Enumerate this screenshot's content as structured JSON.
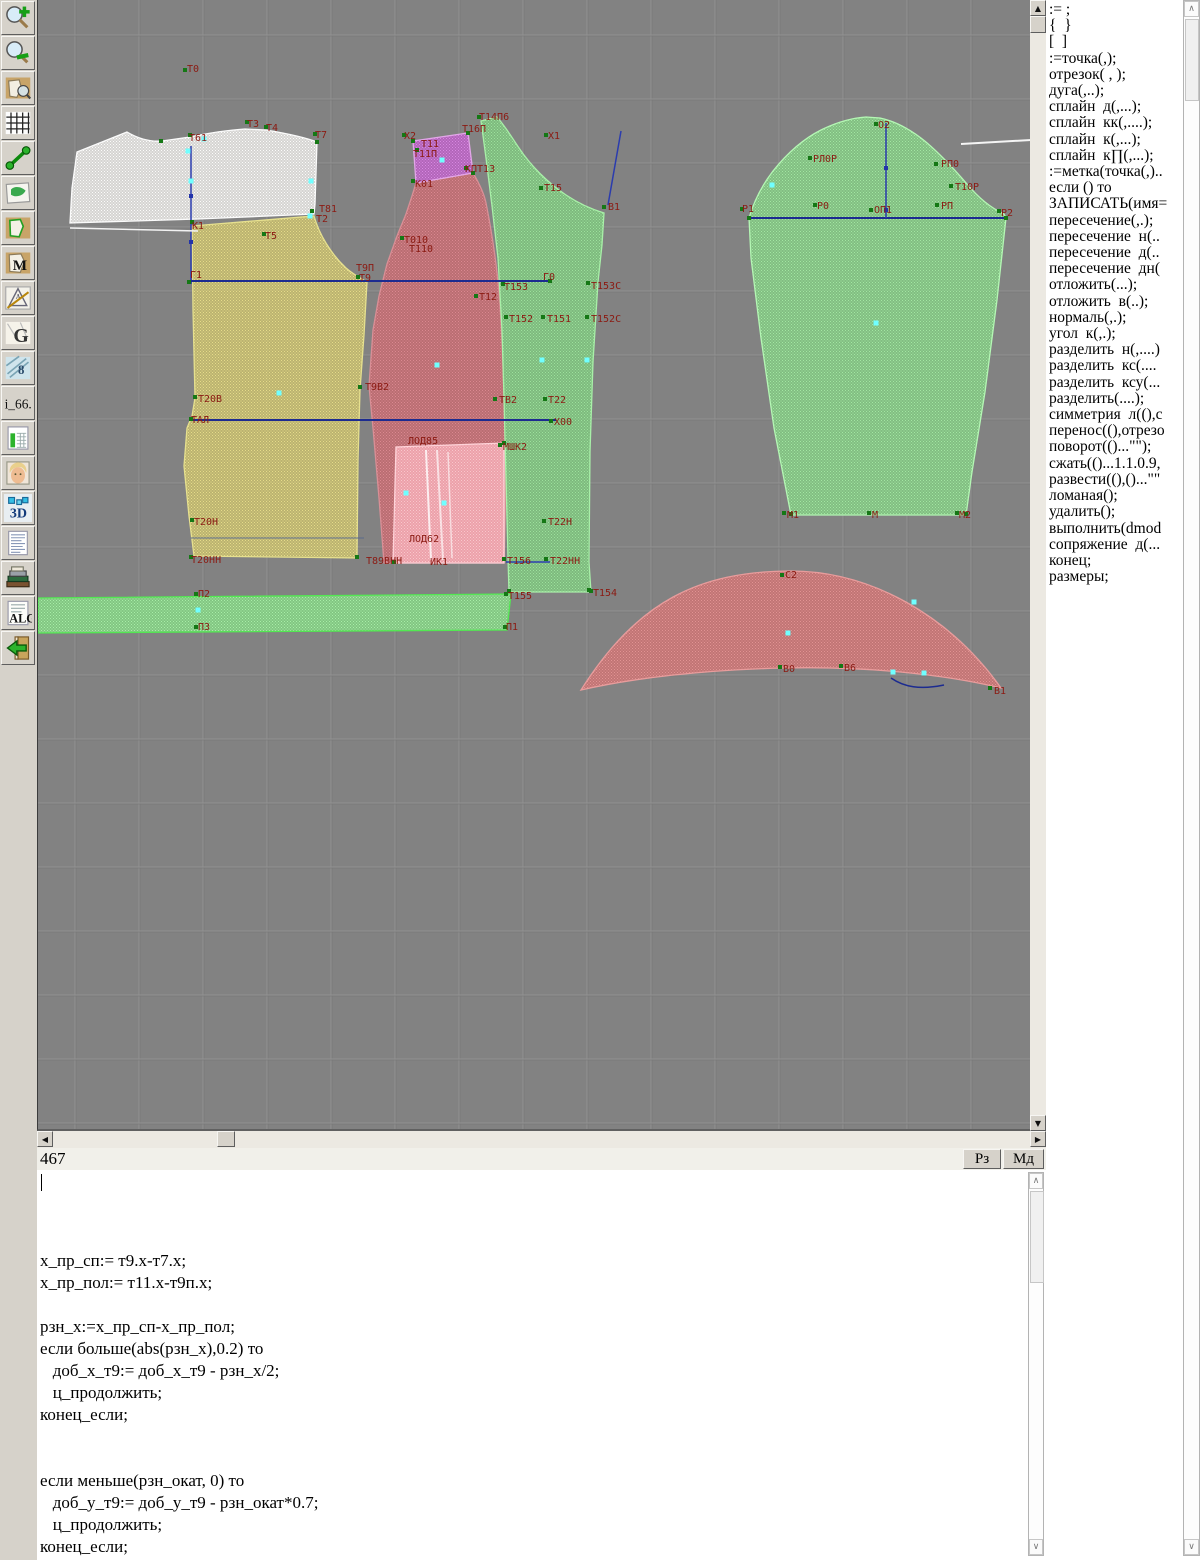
{
  "statusbar": {
    "row_value": "467",
    "buttons": [
      "Рз",
      "Мд"
    ]
  },
  "toolbar": {
    "buttons": [
      {
        "name": "zoom-in"
      },
      {
        "name": "zoom-out"
      },
      {
        "name": "view-pattern"
      },
      {
        "name": "grid"
      },
      {
        "name": "segment"
      },
      {
        "name": "map"
      },
      {
        "name": "pattern-outline"
      },
      {
        "name": "pattern-m",
        "label": "M"
      },
      {
        "name": "drafting",
        "label": "A"
      },
      {
        "name": "pattern-g",
        "label": "G"
      },
      {
        "name": "blueprint",
        "label": "8"
      },
      {
        "name": "i66",
        "label": "i_66."
      },
      {
        "name": "size-chart"
      },
      {
        "name": "model-photo"
      },
      {
        "name": "view-3d",
        "label": "3D"
      },
      {
        "name": "document-text"
      },
      {
        "name": "books"
      },
      {
        "name": "algorithms",
        "label": "ALG"
      },
      {
        "name": "exit"
      }
    ]
  },
  "command_panel": {
    "items": [
      ":= ;",
      "{  }",
      "[  ]",
      ":=точка(,);",
      "отрезок( , );",
      "дуга(,..);",
      "сплайн  д(,...);",
      "сплайн  кк(,....);",
      "сплайн  к(,...);",
      "сплайн  к∏(,...);",
      ":=метка(точка(,)..",
      "если () то",
      "ЗАПИСАТЬ(имя=",
      "пересечение(,.);",
      "пересечение  н(..",
      "пересечение  д(..",
      "пересечение  дн(",
      "отложить(...);",
      "отложить  в(..);",
      "нормаль(,.);",
      "угол  к(,.);",
      "разделить  н(,....)",
      "разделить  кс(....",
      "разделить  ксу(...",
      "разделить(....);",
      "симметрия  л((),с",
      "перенос((),отрезо",
      "поворот(()...\"\");",
      "сжать(()...1.1.0.9,",
      "развести((),()...\"\"",
      "ломаная();",
      "удалить();",
      "выполнить(dmod",
      "сопряжение  д(...",
      "конец;",
      "размеры;"
    ]
  },
  "editor": {
    "lines": [
      "x_пр_сп:= т9.x-т7.x;",
      "x_пр_пол:= т11.x-т9п.x;",
      "",
      "рзн_x:=x_пр_сп-x_пр_пол;",
      "если больше(abs(рзн_x),0.2) то",
      "   доб_x_т9:= доб_x_т9 - рзн_x/2;",
      "   ц_продолжить;",
      "конец_если;",
      "",
      "",
      "если меньше(рзн_окат, 0) то",
      "   доб_у_т9:= доб_у_т9 - рзн_окат*0.7;",
      "   ц_продолжить;",
      "конец_если;"
    ]
  },
  "canvas": {
    "bg": "#828282",
    "grid_light": "#929292",
    "grid_dark": "#747474",
    "grid_step": 64,
    "grid_x0": 37,
    "grid_y0": 35,
    "label_color": "#8b1a12",
    "pieces": [
      {
        "name": "back-yoke",
        "base": "rgba(232,230,228,0.82)",
        "dot": "rgba(255,255,255,0.9)",
        "stroke": "#fbfbfb",
        "d": "M39,152 L89,132 C101,139 112,142 124,141 L152,137 C171,133 191,130 207,129 L228,130 C246,133 266,137 279,142 L277,204 L276,214 L160,219 L32,223 L34,188 Z"
      },
      {
        "name": "back-bottom",
        "base": "rgba(205,195,105,0.75)",
        "dot": "rgba(235,225,140,0.9)",
        "stroke": "#e6e08e",
        "d": "M154,226 L276,216 C281,234 293,254 308,268 C316,275 324,279 329,282 L326,335 L322,390 L320,460 L319,558 L156,556 L151,516 L146,466 L149,428 L154,416 L157,398 L155,310 Z"
      },
      {
        "name": "front-main",
        "base": "rgba(200,105,110,0.8)",
        "dot": "rgba(225,140,150,0.85)",
        "stroke": "#d98f96",
        "d": "M378,183 L435,173 C441,183 446,193 448,203 C453,228 458,258 461,292 C464,332 466,382 467,442 C468,492 467,532 466,563 L346,563 L341,498 L335,428 L331,386 L335,330 L341,296 L349,264 L359,236 L368,214 L374,196 Z"
      },
      {
        "name": "front-inset",
        "base": "rgba(240,165,175,0.92)",
        "dot": "rgba(250,200,205,0.95)",
        "stroke": "#ffd2d8",
        "d": "M358,447 L466,443 L466,563 L355,563 Z"
      },
      {
        "name": "front-upper",
        "base": "rgba(190,95,200,0.8)",
        "dot": "rgba(220,140,230,0.9)",
        "stroke": "#e2a6e8",
        "d": "M375,141 L430,133 L435,173 L378,183 Z"
      },
      {
        "name": "side-panel",
        "base": "rgba(125,200,125,0.8)",
        "dot": "rgba(160,230,160,0.9)",
        "stroke": "#a8f0a8",
        "d": "M443,121 L459,117 C467,126 473,136 481,148 C493,166 510,183 528,195 C540,203 553,209 566,213 L564,245 L560,282 L555,362 L552,452 L551,562 L553,592 L471,592 L470,558 L468,478 L466,398 L464,330 L460,258 L454,206 L448,158 Z"
      },
      {
        "name": "sleeve",
        "base": "rgba(130,205,130,0.8)",
        "dot": "rgba(165,235,165,0.9)",
        "stroke": "#b4f7b4",
        "d": "M711,218 C716,201 725,184 735,171 C747,156 763,140 783,130 C799,122 814,118 828,117 L842,118 C856,121 871,128 888,142 C902,154 917,170 929,184 C939,196 951,207 966,214 L968,218 L959,300 L947,392 L934,472 L928,515 L753,515 L736,428 L723,338 L713,258 Z"
      },
      {
        "name": "collar",
        "base": "rgba(205,115,115,0.85)",
        "dot": "rgba(230,150,150,0.9)",
        "stroke": "#e89c9c",
        "d": "M543,690 C600,600 662,572 750,571 C832,570 912,616 963,688 C905,674 825,666 745,668 C665,670 595,678 543,690 Z"
      },
      {
        "name": "waistband-strip",
        "base": "rgba(130,210,130,0.85)",
        "dot": "rgba(170,240,170,0.95)",
        "stroke": "#52e852",
        "d": "M0,598 L473,594 L469,630 L0,633 Z"
      }
    ],
    "lines": [
      [
        "#2b3cae",
        153,
        146,
        153,
        284,
        1.5
      ],
      [
        "#1c2b90",
        153,
        281,
        513,
        281,
        2
      ],
      [
        "#1c2b90",
        153,
        420,
        518,
        420,
        2
      ],
      [
        "#2b3cae",
        468,
        562,
        512,
        562,
        1.5
      ],
      [
        "#2b3cae",
        583,
        131,
        570,
        205,
        1.5
      ],
      [
        "#1c2b90",
        711,
        218,
        968,
        218,
        2
      ],
      [
        "#2b3cae",
        848,
        123,
        848,
        218,
        1.5
      ],
      [
        "#5a6a8a",
        153,
        538,
        326,
        538,
        1
      ],
      [
        "#f2f2f2",
        32,
        228,
        160,
        231,
        1.5
      ],
      [
        "#f5f5f5",
        923,
        144,
        993,
        140,
        2
      ],
      [
        "rgba(255,255,255,0.8)",
        388,
        450,
        393,
        560,
        2
      ],
      [
        "rgba(255,255,255,0.65)",
        399,
        450,
        405,
        560,
        2
      ],
      [
        "rgba(255,255,255,0.6)",
        410,
        452,
        414,
        558,
        1.5
      ]
    ],
    "curves": [
      {
        "d": "M853,678 C866,687 882,690 906,685",
        "color": "#1c2b90",
        "w": 1.5
      }
    ],
    "markers_green": [
      [
        147,
        70
      ],
      [
        152,
        135
      ],
      [
        209,
        122
      ],
      [
        228,
        127
      ],
      [
        277,
        134
      ],
      [
        274,
        211
      ],
      [
        154,
        222
      ],
      [
        226,
        234
      ],
      [
        151,
        282
      ],
      [
        320,
        277
      ],
      [
        157,
        397
      ],
      [
        153,
        419
      ],
      [
        322,
        387
      ],
      [
        154,
        520
      ],
      [
        153,
        557
      ],
      [
        158,
        594
      ],
      [
        158,
        627
      ],
      [
        467,
        627
      ],
      [
        468,
        594
      ],
      [
        366,
        135
      ],
      [
        379,
        150
      ],
      [
        375,
        181
      ],
      [
        428,
        168
      ],
      [
        364,
        238
      ],
      [
        441,
        117
      ],
      [
        508,
        135
      ],
      [
        503,
        188
      ],
      [
        566,
        207
      ],
      [
        465,
        284
      ],
      [
        550,
        283
      ],
      [
        438,
        296
      ],
      [
        468,
        317
      ],
      [
        505,
        317
      ],
      [
        549,
        317
      ],
      [
        512,
        281
      ],
      [
        457,
        399
      ],
      [
        507,
        399
      ],
      [
        513,
        421
      ],
      [
        462,
        445
      ],
      [
        506,
        521
      ],
      [
        466,
        559
      ],
      [
        508,
        559
      ],
      [
        551,
        590
      ],
      [
        838,
        124
      ],
      [
        772,
        158
      ],
      [
        898,
        164
      ],
      [
        913,
        186
      ],
      [
        777,
        205
      ],
      [
        833,
        210
      ],
      [
        899,
        205
      ],
      [
        704,
        209
      ],
      [
        961,
        211
      ],
      [
        746,
        513
      ],
      [
        831,
        513
      ],
      [
        919,
        513
      ],
      [
        744,
        575
      ],
      [
        742,
        667
      ],
      [
        803,
        666
      ],
      [
        952,
        688
      ],
      [
        123,
        141
      ],
      [
        279,
        142
      ],
      [
        319,
        557
      ],
      [
        435,
        173
      ],
      [
        375,
        141
      ],
      [
        430,
        133
      ],
      [
        553,
        591
      ],
      [
        471,
        591
      ],
      [
        711,
        218
      ],
      [
        968,
        218
      ],
      [
        928,
        514
      ],
      [
        753,
        514
      ],
      [
        356,
        562
      ],
      [
        466,
        443
      ]
    ],
    "markers_cyan": [
      [
        150,
        151
      ],
      [
        153,
        181
      ],
      [
        166,
        139
      ],
      [
        273,
        181
      ],
      [
        272,
        216
      ],
      [
        241,
        393
      ],
      [
        404,
        160
      ],
      [
        399,
        365
      ],
      [
        406,
        503
      ],
      [
        368,
        493
      ],
      [
        504,
        360
      ],
      [
        549,
        360
      ],
      [
        838,
        323
      ],
      [
        734,
        185
      ],
      [
        750,
        633
      ],
      [
        876,
        602
      ],
      [
        855,
        672
      ],
      [
        886,
        673
      ],
      [
        160,
        610
      ]
    ],
    "markers_blue": [
      [
        848,
        168
      ],
      [
        848,
        210
      ],
      [
        153,
        196
      ],
      [
        153,
        242
      ]
    ],
    "labels": [
      [
        "Т0",
        149,
        72
      ],
      [
        "Т61",
        151,
        141
      ],
      [
        "Т3",
        209,
        127
      ],
      [
        "Т4",
        228,
        131
      ],
      [
        "Т7",
        277,
        138
      ],
      [
        "Т81",
        281,
        212
      ],
      [
        "Т2",
        278,
        222
      ],
      [
        "К1",
        154,
        229
      ],
      [
        "Т5",
        227,
        239
      ],
      [
        "Г1",
        152,
        278
      ],
      [
        "Т9П",
        318,
        271
      ],
      [
        "Т9",
        321,
        281
      ],
      [
        "Т20В",
        160,
        402
      ],
      [
        "ТАЛ",
        153,
        423
      ],
      [
        "Т9В2",
        327,
        390
      ],
      [
        "Т20Н",
        156,
        525
      ],
      [
        "Т20НН",
        153,
        563
      ],
      [
        "П2",
        160,
        597
      ],
      [
        "П3",
        160,
        630
      ],
      [
        "П1",
        468,
        630
      ],
      [
        "Т155",
        470,
        599
      ],
      [
        "Х2",
        366,
        139
      ],
      [
        "Т11",
        383,
        147
      ],
      [
        "Т11П",
        375,
        157
      ],
      [
        "К01",
        377,
        187
      ],
      [
        "КПТ13",
        427,
        172
      ],
      [
        "Т010",
        366,
        243
      ],
      [
        "Т110",
        371,
        252
      ],
      [
        "ЛОД85",
        370,
        444
      ],
      [
        "ЛОД62",
        371,
        542
      ],
      [
        "Т89ВНН",
        328,
        564
      ],
      [
        "ИК1",
        392,
        565
      ],
      [
        "Т14П6",
        441,
        120
      ],
      [
        "Т16П",
        424,
        132
      ],
      [
        "Х1",
        510,
        139
      ],
      [
        "Т15",
        506,
        191
      ],
      [
        "В1",
        570,
        210
      ],
      [
        "Г0",
        505,
        280
      ],
      [
        "Т153",
        466,
        290
      ],
      [
        "Т153С",
        553,
        289
      ],
      [
        "Т12",
        441,
        300
      ],
      [
        "Т152",
        471,
        322
      ],
      [
        "Т151",
        509,
        322
      ],
      [
        "Т152С",
        553,
        322
      ],
      [
        "ТВ2",
        461,
        403
      ],
      [
        "Т22",
        510,
        403
      ],
      [
        "Х00",
        516,
        425
      ],
      [
        "МШК2",
        465,
        450
      ],
      [
        "Т22Н",
        510,
        525
      ],
      [
        "Т156",
        469,
        564
      ],
      [
        "Т22НН",
        512,
        564
      ],
      [
        "Т154",
        555,
        596
      ],
      [
        "О2",
        840,
        128
      ],
      [
        "РЛ0Р",
        775,
        162
      ],
      [
        "РП0",
        903,
        167
      ],
      [
        "Т10Р",
        917,
        190
      ],
      [
        "Р0",
        779,
        209
      ],
      [
        "ОП1",
        836,
        213
      ],
      [
        "РП",
        903,
        209
      ],
      [
        "Р1",
        704,
        212
      ],
      [
        "Р2",
        963,
        216
      ],
      [
        "М1",
        749,
        518
      ],
      [
        "М",
        834,
        518
      ],
      [
        "М2",
        921,
        518
      ],
      [
        "С2",
        747,
        578
      ],
      [
        "В0",
        745,
        672
      ],
      [
        "В6",
        806,
        671
      ],
      [
        "В1",
        956,
        694
      ]
    ]
  }
}
